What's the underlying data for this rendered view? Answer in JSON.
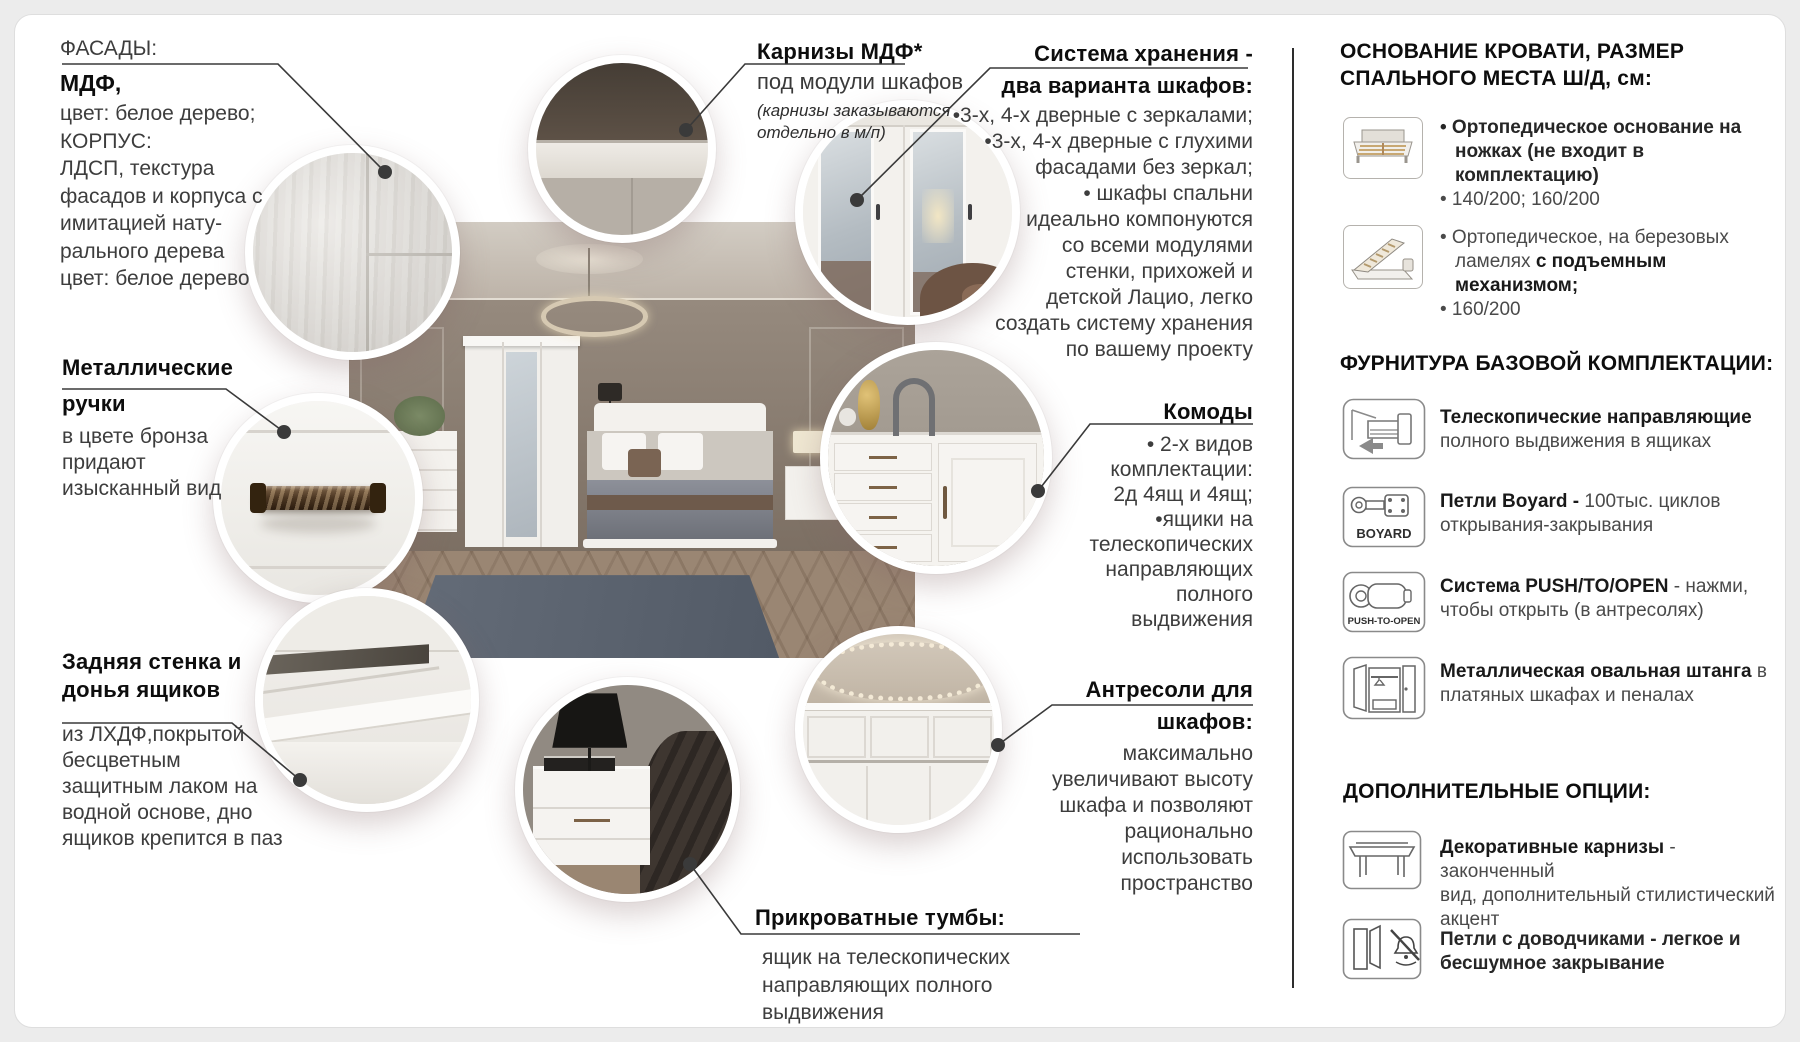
{
  "page": {
    "background": "#ececec",
    "card_background": "#ffffff",
    "divider_color": "#2d2d2d",
    "line_color": "#3a3a3a"
  },
  "callouts": {
    "facades": {
      "label": "ФАСАДЫ:",
      "title": "МДФ,",
      "lines": [
        "цвет: белое дерево;",
        "КОРПУС:",
        "ЛДСП, текстура",
        "фасадов и корпуса с",
        "имитацией нату-",
        "рального дерева",
        "цвет: белое дерево"
      ]
    },
    "cornices": {
      "title": "Карнизы МДФ*",
      "line": "под модули шкафов",
      "note": [
        "(карнизы заказываются",
        "отдельно в м/п)"
      ]
    },
    "storage": {
      "title": [
        "Система хранения -",
        "два варианта шкафов:"
      ],
      "lines": [
        "•3-х, 4-х дверные с зеркалами;",
        "•3-х, 4-х дверные с глухими",
        "фасадами без зеркал;",
        "• шкафы спальни",
        "идеально компонуются",
        "со всеми модулями",
        "стенки, прихожей и",
        "детской Лацио, легко",
        "создать систему хранения",
        "по вашему проекту"
      ]
    },
    "handles": {
      "title": [
        "Металлические",
        "ручки"
      ],
      "lines": [
        "в цвете бронза",
        "придают",
        "изысканный вид"
      ]
    },
    "dressers": {
      "title": "Комоды",
      "lines": [
        "• 2-х видов",
        "комплектации:",
        "2д 4ящ и 4ящ;",
        "•ящики на",
        "телескопических",
        "направляющих",
        "полного",
        "выдвижения"
      ]
    },
    "back_wall": {
      "title": [
        "Задняя стенка и",
        "донья ящиков"
      ],
      "lines": [
        "из ЛХДФ,покрытой",
        "бесцветным",
        "защитным лаком на",
        "водной основе, дно",
        "ящиков крепится в паз"
      ]
    },
    "mezzanines": {
      "title": [
        "Антресоли для",
        "шкафов:"
      ],
      "lines": [
        "максимально",
        "увеличивают высоту",
        "шкафа и позволяют",
        "рационально",
        "использовать",
        "пространство"
      ]
    },
    "nightstands": {
      "title": "Прикроватные тумбы:",
      "lines": [
        "ящик на телескопических",
        "направляющих полного выдвижения"
      ]
    }
  },
  "sidebar": {
    "bed_title": [
      "ОСНОВАНИЕ КРОВАТИ, РАЗМЕР",
      "СПАЛЬНОГО МЕСТА Ш/Д, см:"
    ],
    "bed_items": [
      {
        "icon": "bed-orthopedic-icon",
        "l1": "• Ортопедическое основание на",
        "l2": "ножках (не входит в комплектацию)",
        "l3": "• 140/200; 160/200"
      },
      {
        "icon": "bed-lift-icon",
        "l1": "• Ортопедическое, на березовых",
        "l2a": "ламелях ",
        "l2b": "с подъемным механизмом;",
        "l3": "• 160/200"
      }
    ],
    "hardware_title": "ФУРНИТУРА БАЗОВОЙ КОМПЛЕКТАЦИИ:",
    "hardware_items": [
      {
        "icon": "drawer-slides-icon",
        "b": "Телескопические направляющие",
        "r2": "полного выдвижения в ящиках"
      },
      {
        "icon": "boyard-hinge-icon",
        "badge": "BOYARD",
        "b": "Петли Boyard - ",
        "r1": "100тыс. циклов",
        "r2": "открывания-закрывания"
      },
      {
        "icon": "push-to-open-icon",
        "badge": "PUSH-TO-OPEN",
        "b": "Система PUSH/TO/OPEN",
        "r1": " - нажми,",
        "r2": "чтобы открыть (в антресолях)"
      },
      {
        "icon": "oval-rail-wardrobe-icon",
        "b": "Металлическая овальная штанга",
        "r1": " в",
        "r2": "платяных шкафах и пеналах"
      }
    ],
    "options_title": "ДОПОЛНИТЕЛЬНЫЕ ОПЦИИ:",
    "options_items": [
      {
        "icon": "decorative-cornice-icon",
        "b": "Декоративные карнизы",
        "r1": " - законченный",
        "r2": "вид, дополнительный стилистический",
        "r3": "акцент"
      },
      {
        "icon": "soft-close-hinge-icon",
        "b1": "Петли с доводчиками - легкое и",
        "b2": "бесшумное закрывание"
      }
    ]
  }
}
